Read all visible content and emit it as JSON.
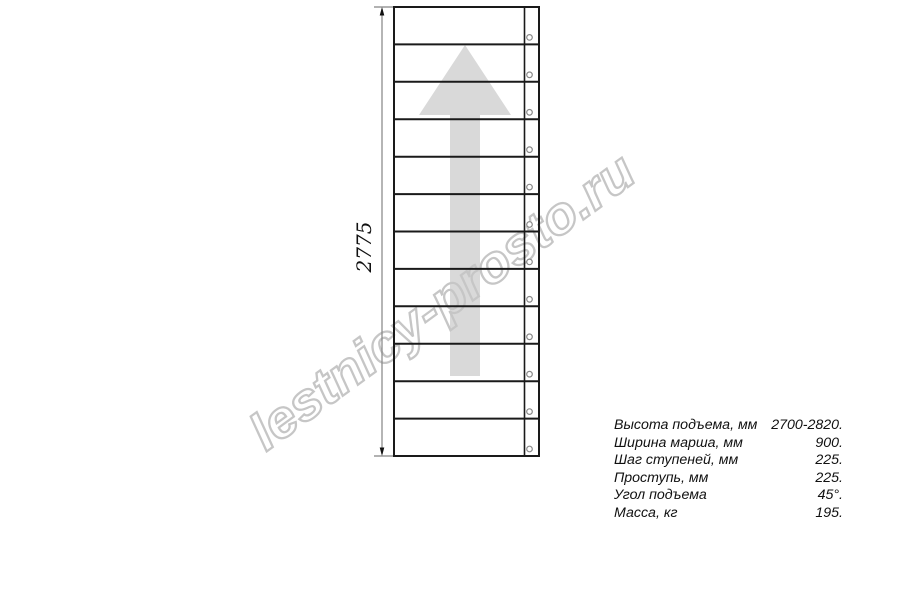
{
  "drawing": {
    "title": "staircase-plan-view",
    "dimension_label": "2775",
    "watermark_text": "lestnicy-prosto.ru",
    "steps_count": 12,
    "holes_count": 12
  },
  "specs": {
    "rows": [
      {
        "label": "Высота подъема, мм",
        "value": "2700-2820."
      },
      {
        "label": "Ширина марша, мм",
        "value": "900."
      },
      {
        "label": "Шаг ступеней, мм",
        "value": "225."
      },
      {
        "label": "Проступь, мм",
        "value": "225."
      },
      {
        "label": "Угол подъема",
        "value": "45°."
      },
      {
        "label": "Масса, кг",
        "value": "195."
      }
    ]
  },
  "colors": {
    "line": "#1a1a1a",
    "dimension": "#848484",
    "arrow_fill": "#d9d9d9",
    "watermark_stroke": "#c6c6c6",
    "hole_stroke": "#8a8a8a",
    "background": "#ffffff"
  }
}
